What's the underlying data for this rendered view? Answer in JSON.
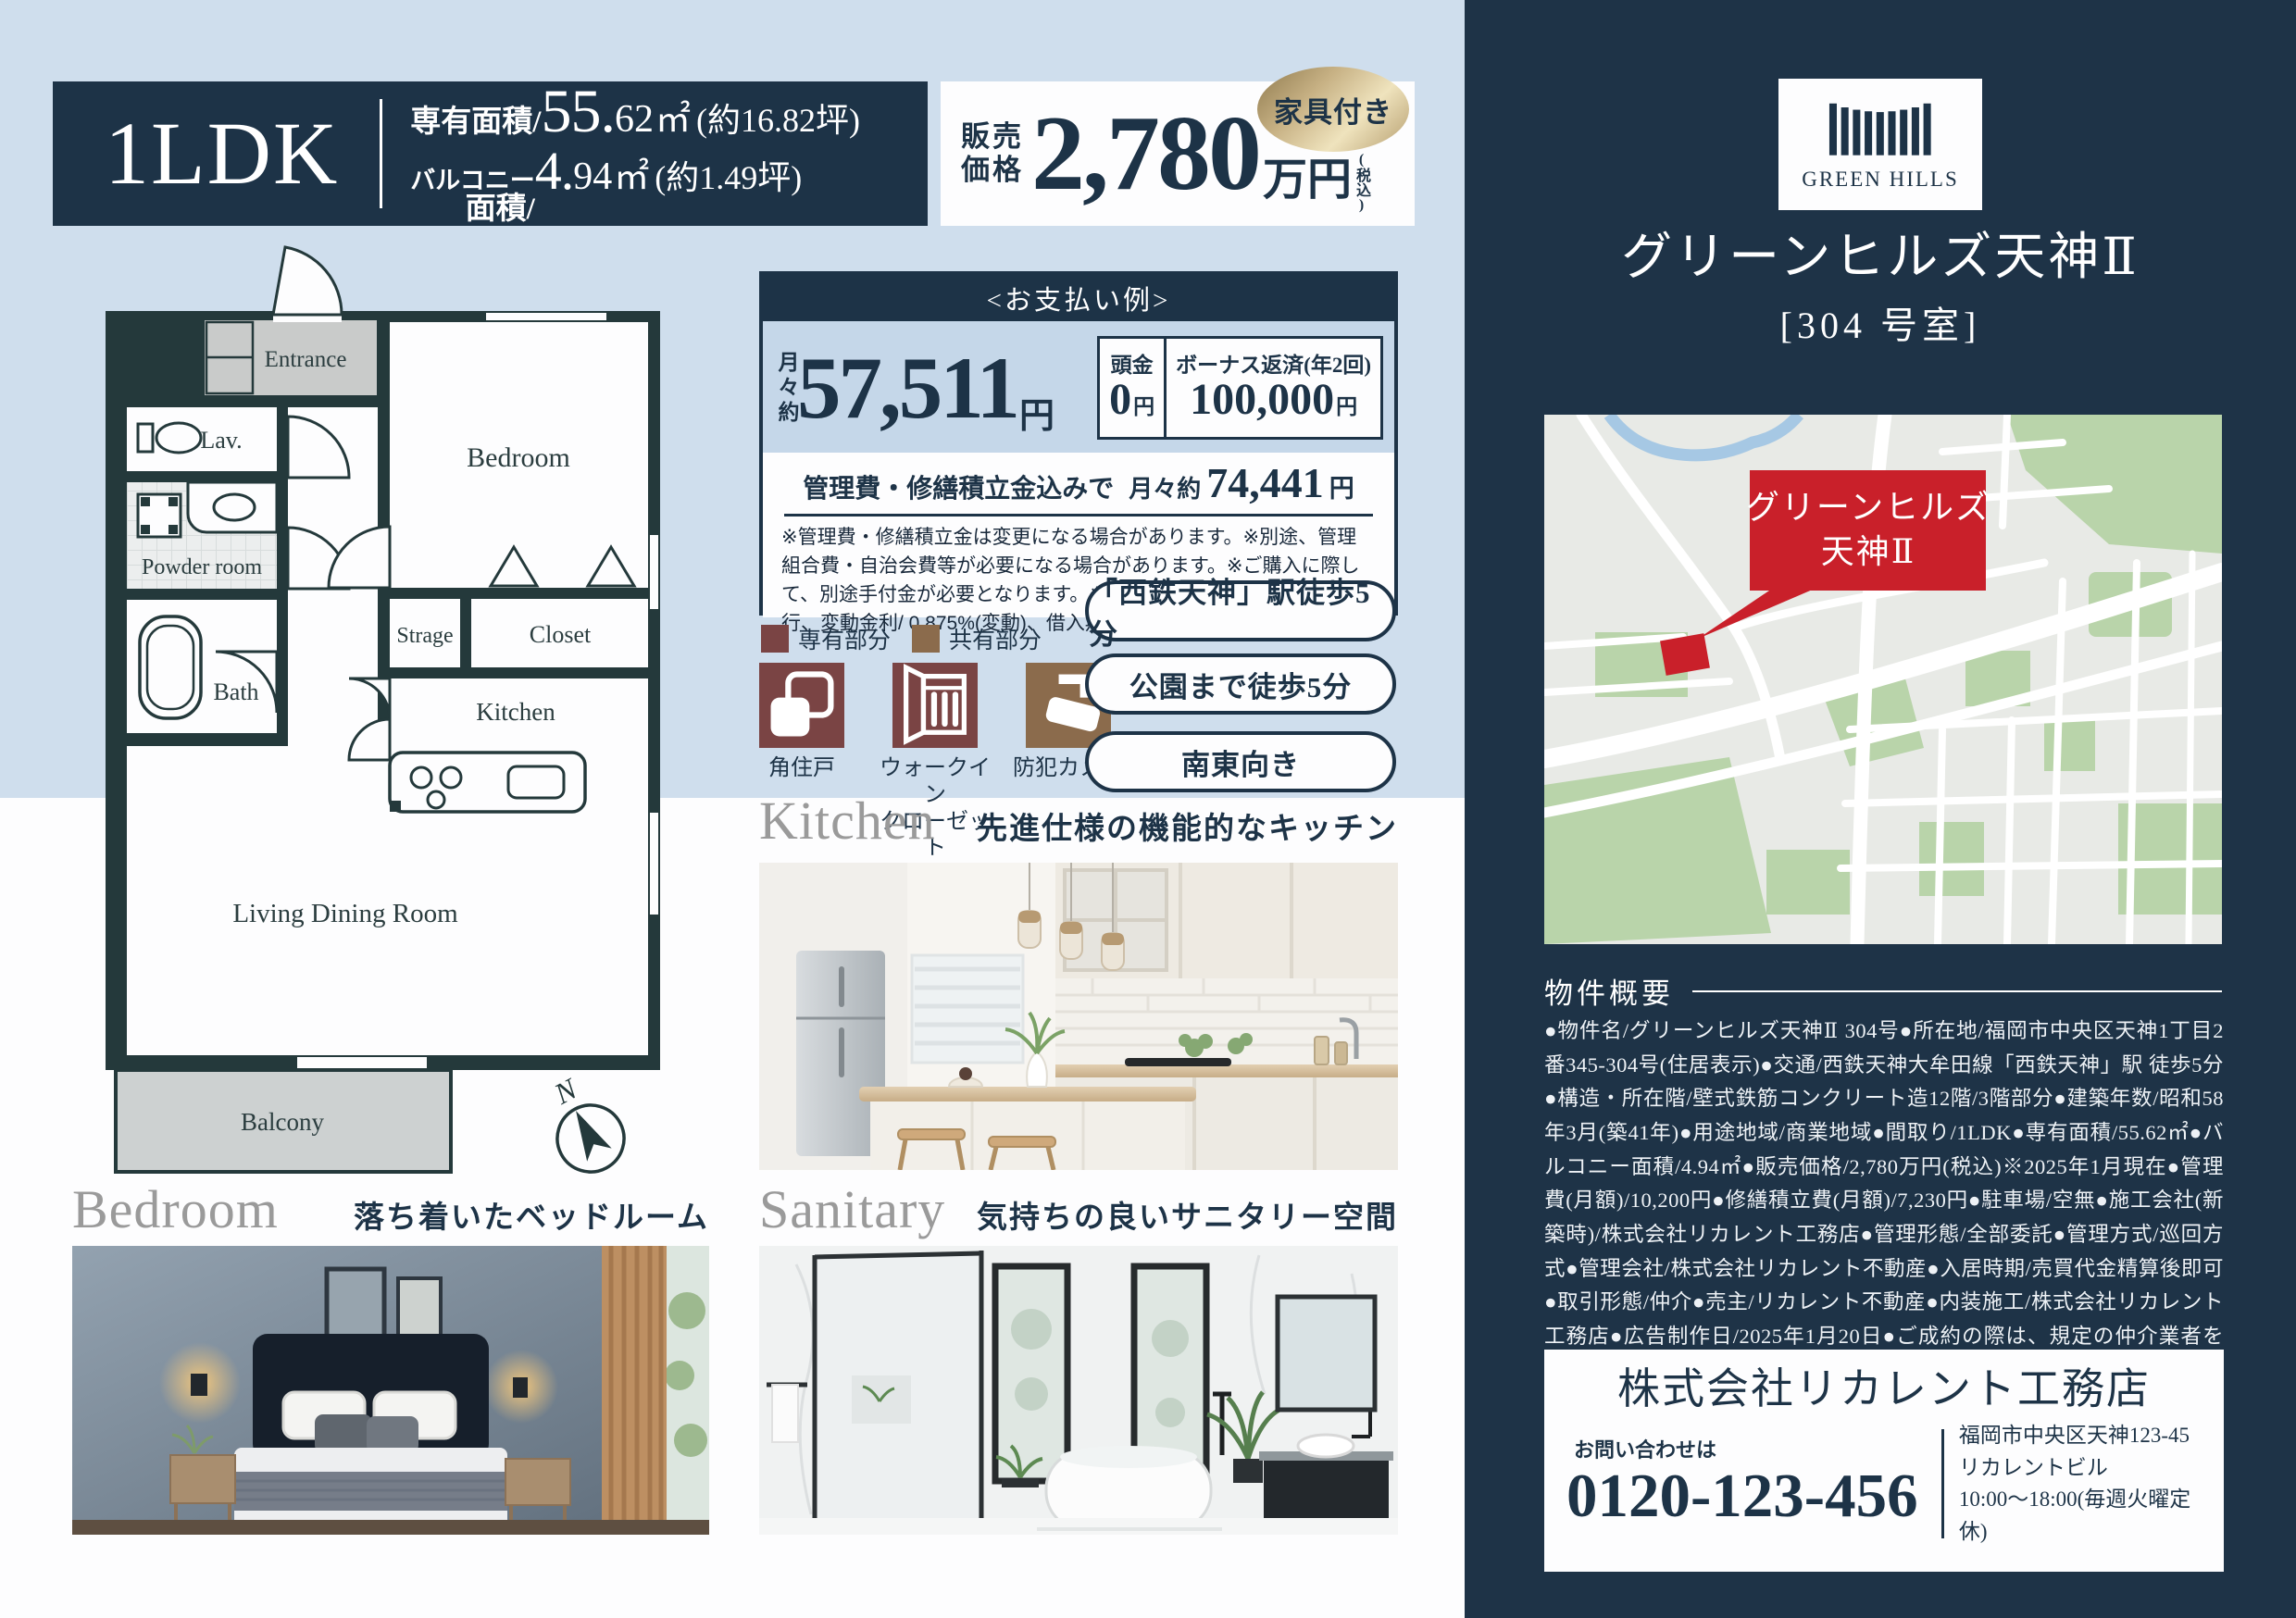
{
  "palette": {
    "navy": "#1d3347",
    "sidebar_navy": "#1e3347",
    "light_blue_bg": "#cfdeed",
    "payment_blue": "#c5d7e9",
    "wall_dark": "#24393b",
    "map_red": "#c9202a",
    "gold_light": "#efe3bd",
    "gold_dark": "#8f7a4e",
    "legend_exclusive": "#7a4444",
    "legend_shared": "#8b6b4c"
  },
  "header": {
    "plan_type": "1LDK",
    "area_label": "専有面積/",
    "area_int": "55.",
    "area_dec": "62",
    "area_unit": "㎡",
    "area_tsubo": "(約16.82坪)",
    "balcony_label1": "バルコニー",
    "balcony_label2": "面積/",
    "balcony_int": "4.",
    "balcony_dec": "94",
    "balcony_unit": "㎡",
    "balcony_tsubo": "(約1.49坪)",
    "price_label1": "販売",
    "price_label2": "価格",
    "price_value": "2,780",
    "price_unit": "万円",
    "price_tax": "(税込)",
    "furniture_badge": "家具付き"
  },
  "floorplan": {
    "rooms": {
      "entrance": "Entrance",
      "lav": "Lav.",
      "powder": "Powder room",
      "bath": "Bath",
      "bedroom": "Bedroom",
      "strage": "Strage",
      "closet": "Closet",
      "kitchen": "Kitchen",
      "ldk": "Living Dining Room",
      "balcony": "Balcony"
    },
    "compass": "N"
  },
  "payment": {
    "title": "<お支払い例>",
    "monthly_prefix": "月々約",
    "monthly_value": "57,511",
    "monthly_unit": "円",
    "down_label": "頭金",
    "down_value": "0",
    "down_unit": "円",
    "bonus_label": "ボーナス返済(年2回)",
    "bonus_value": "100,000",
    "bonus_unit": "円",
    "incl_label": "管理費・修繕積立金込みで",
    "incl_prefix": "月々約",
    "incl_value": "74,441",
    "incl_unit": "円",
    "disclaimer": "※管理費・修繕積立金は変更になる場合があります。※別途、管理組合費・自治会費等が必要になる場合があります。※ご購入に際して、別途手付金が必要となります。※提携ローン/西日本シティ銀行、変動金利/ 0.875%(変動)、借入期間/35 年"
  },
  "legend": {
    "exclusive": "専有部分",
    "shared": "共有部分"
  },
  "features": {
    "items": [
      {
        "label": "角住戸"
      },
      {
        "label": "ウォークイン\nクローゼット"
      },
      {
        "label": "防犯カメラ"
      }
    ]
  },
  "badges": {
    "items": [
      "「西鉄天神」駅徒歩5分",
      "公園まで徒歩5分",
      "南東向き"
    ]
  },
  "sections": {
    "kitchen": {
      "en": "Kitchen",
      "ja": "先進仕様の機能的なキッチン"
    },
    "bedroom": {
      "en": "Bedroom",
      "ja": "落ち着いたベッドルーム"
    },
    "sanitary": {
      "en": "Sanitary",
      "ja": "気持ちの良いサニタリー空間"
    }
  },
  "sidebar": {
    "logo_text": "GREEN HILLS",
    "title": "グリーンヒルズ天神Ⅱ",
    "room": "[304 号室]",
    "map": {
      "label1": "グリーンヒルズ",
      "label2": "天神Ⅱ"
    },
    "overview_title": "物件概要",
    "overview_text": "●物件名/グリーンヒルズ天神Ⅱ 304号●所在地/福岡市中央区天神1丁目2番345-304号(住居表示)●交通/西鉄天神大牟田線「西鉄天神」駅 徒歩5分●構造・所在階/壁式鉄筋コンクリート造12階/3階部分●建築年数/昭和58年3月(築41年)●用途地域/商業地域●間取り/1LDK●専有面積/55.62㎡●バルコニー面積/4.94㎡●販売価格/2,780万円(税込)※2025年1月現在●管理費(月額)/10,200円●修繕積立費(月額)/7,230円●駐車場/空無●施工会社(新築時)/株式会社リカレント工務店●管理形態/全部委託●管理方式/巡回方式●管理会社/株式会社リカレント不動産●入居時期/売買代金精算後即可●取引形態/仲介●売主/リカレント不動産●内装施工/株式会社リカレント工務店●広告制作日/2025年1月20日●ご成約の際は、規定の仲介業者を別途申し受けます。",
    "contact": {
      "company": "株式会社リカレント工務店",
      "inquiry_label": "お問い合わせは",
      "phone": "0120-123-456",
      "address1": "福岡市中央区天神123-45",
      "address2": "リカレントビル",
      "hours": "10:00〜18:00(毎週火曜定休)"
    }
  }
}
